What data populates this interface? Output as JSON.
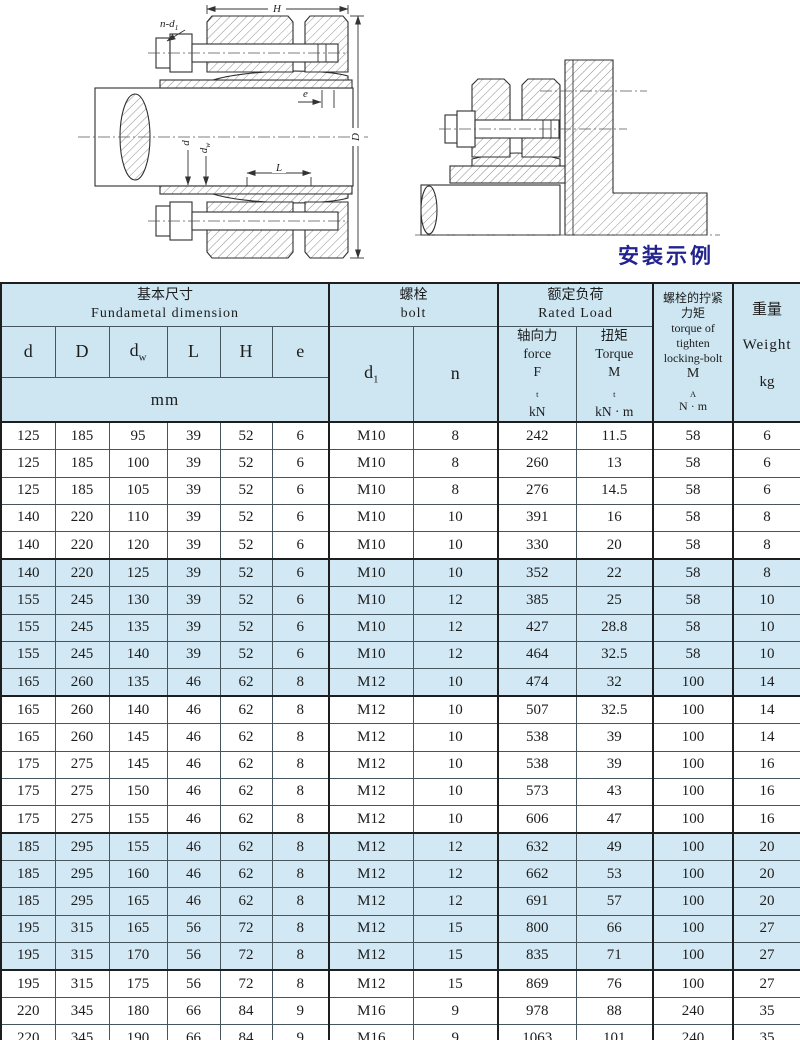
{
  "figures": {
    "caption": "安装示例",
    "left_labels": {
      "H": "H",
      "nd1_main": "n-d",
      "nd1_sub": "1",
      "e": "e",
      "D": "D",
      "d": "d",
      "dw_main": "d",
      "dw_sub": "w",
      "L": "L"
    }
  },
  "table": {
    "header": {
      "basic": {
        "zh": "基本尺寸",
        "en": "Fundametal  dimension"
      },
      "bolt": {
        "zh": "螺栓",
        "en": "bolt"
      },
      "rated": {
        "zh": "额定负荷",
        "en": "Rated  Load"
      },
      "tighten": {
        "zh1": "螺栓的拧紧",
        "zh2": "力矩",
        "en1": "torque of",
        "en2": "tighten",
        "en3": "locking-bolt",
        "sym": "M",
        "sym_sub": "A",
        "unit": "N · m"
      },
      "weight": {
        "zh": "重量",
        "en": "Weight",
        "unit": "kg"
      },
      "cols": {
        "d": "d",
        "D": "D",
        "dw_main": "d",
        "dw_sub": "w",
        "L": "L",
        "H": "H",
        "e": "e",
        "d1_main": "d",
        "d1_sub": "1",
        "n": "n",
        "force": {
          "zh": "轴向力",
          "en": "force",
          "sym": "F",
          "sym_sub": "t",
          "unit": "kN"
        },
        "torque": {
          "zh": "扭矩",
          "en": "Torque",
          "sym": "M",
          "sym_sub": "t",
          "unit": "kN · m"
        }
      },
      "mm": "mm"
    },
    "rows": [
      {
        "cells": [
          "125",
          "185",
          "95",
          "39",
          "52",
          "6",
          "M10",
          "8",
          "242",
          "11.5",
          "58",
          "6"
        ],
        "shaded": false
      },
      {
        "cells": [
          "125",
          "185",
          "100",
          "39",
          "52",
          "6",
          "M10",
          "8",
          "260",
          "13",
          "58",
          "6"
        ],
        "shaded": false
      },
      {
        "cells": [
          "125",
          "185",
          "105",
          "39",
          "52",
          "6",
          "M10",
          "8",
          "276",
          "14.5",
          "58",
          "6"
        ],
        "shaded": false
      },
      {
        "cells": [
          "140",
          "220",
          "110",
          "39",
          "52",
          "6",
          "M10",
          "10",
          "391",
          "16",
          "58",
          "8"
        ],
        "shaded": false
      },
      {
        "cells": [
          "140",
          "220",
          "120",
          "39",
          "52",
          "6",
          "M10",
          "10",
          "330",
          "20",
          "58",
          "8"
        ],
        "shaded": false
      },
      {
        "cells": [
          "140",
          "220",
          "125",
          "39",
          "52",
          "6",
          "M10",
          "10",
          "352",
          "22",
          "58",
          "8"
        ],
        "shaded": true
      },
      {
        "cells": [
          "155",
          "245",
          "130",
          "39",
          "52",
          "6",
          "M10",
          "12",
          "385",
          "25",
          "58",
          "10"
        ],
        "shaded": true
      },
      {
        "cells": [
          "155",
          "245",
          "135",
          "39",
          "52",
          "6",
          "M10",
          "12",
          "427",
          "28.8",
          "58",
          "10"
        ],
        "shaded": true
      },
      {
        "cells": [
          "155",
          "245",
          "140",
          "39",
          "52",
          "6",
          "M10",
          "12",
          "464",
          "32.5",
          "58",
          "10"
        ],
        "shaded": true
      },
      {
        "cells": [
          "165",
          "260",
          "135",
          "46",
          "62",
          "8",
          "M12",
          "10",
          "474",
          "32",
          "100",
          "14"
        ],
        "shaded": true
      },
      {
        "cells": [
          "165",
          "260",
          "140",
          "46",
          "62",
          "8",
          "M12",
          "10",
          "507",
          "32.5",
          "100",
          "14"
        ],
        "shaded": false
      },
      {
        "cells": [
          "165",
          "260",
          "145",
          "46",
          "62",
          "8",
          "M12",
          "10",
          "538",
          "39",
          "100",
          "14"
        ],
        "shaded": false
      },
      {
        "cells": [
          "175",
          "275",
          "145",
          "46",
          "62",
          "8",
          "M12",
          "10",
          "538",
          "39",
          "100",
          "16"
        ],
        "shaded": false
      },
      {
        "cells": [
          "175",
          "275",
          "150",
          "46",
          "62",
          "8",
          "M12",
          "10",
          "573",
          "43",
          "100",
          "16"
        ],
        "shaded": false
      },
      {
        "cells": [
          "175",
          "275",
          "155",
          "46",
          "62",
          "8",
          "M12",
          "10",
          "606",
          "47",
          "100",
          "16"
        ],
        "shaded": false
      },
      {
        "cells": [
          "185",
          "295",
          "155",
          "46",
          "62",
          "8",
          "M12",
          "12",
          "632",
          "49",
          "100",
          "20"
        ],
        "shaded": true
      },
      {
        "cells": [
          "185",
          "295",
          "160",
          "46",
          "62",
          "8",
          "M12",
          "12",
          "662",
          "53",
          "100",
          "20"
        ],
        "shaded": true
      },
      {
        "cells": [
          "185",
          "295",
          "165",
          "46",
          "62",
          "8",
          "M12",
          "12",
          "691",
          "57",
          "100",
          "20"
        ],
        "shaded": true
      },
      {
        "cells": [
          "195",
          "315",
          "165",
          "56",
          "72",
          "8",
          "M12",
          "15",
          "800",
          "66",
          "100",
          "27"
        ],
        "shaded": true
      },
      {
        "cells": [
          "195",
          "315",
          "170",
          "56",
          "72",
          "8",
          "M12",
          "15",
          "835",
          "71",
          "100",
          "27"
        ],
        "shaded": true
      },
      {
        "cells": [
          "195",
          "315",
          "175",
          "56",
          "72",
          "8",
          "M12",
          "15",
          "869",
          "76",
          "100",
          "27"
        ],
        "shaded": false
      },
      {
        "cells": [
          "220",
          "345",
          "180",
          "66",
          "84",
          "9",
          "M16",
          "9",
          "978",
          "88",
          "240",
          "35"
        ],
        "shaded": false
      },
      {
        "cells": [
          "220",
          "345",
          "190",
          "66",
          "84",
          "9",
          "M16",
          "9",
          "1063",
          "101",
          "240",
          "35"
        ],
        "shaded": false
      },
      {
        "cells": [
          "220",
          "345",
          "200",
          "66",
          "84",
          "9",
          "M16",
          "9",
          "1140",
          "114",
          "240",
          "35"
        ],
        "shaded": false
      }
    ],
    "colors": {
      "header_bg": "#cde6f2",
      "shaded_row_bg": "#d2e9f5",
      "caption_color": "#23238f"
    }
  }
}
